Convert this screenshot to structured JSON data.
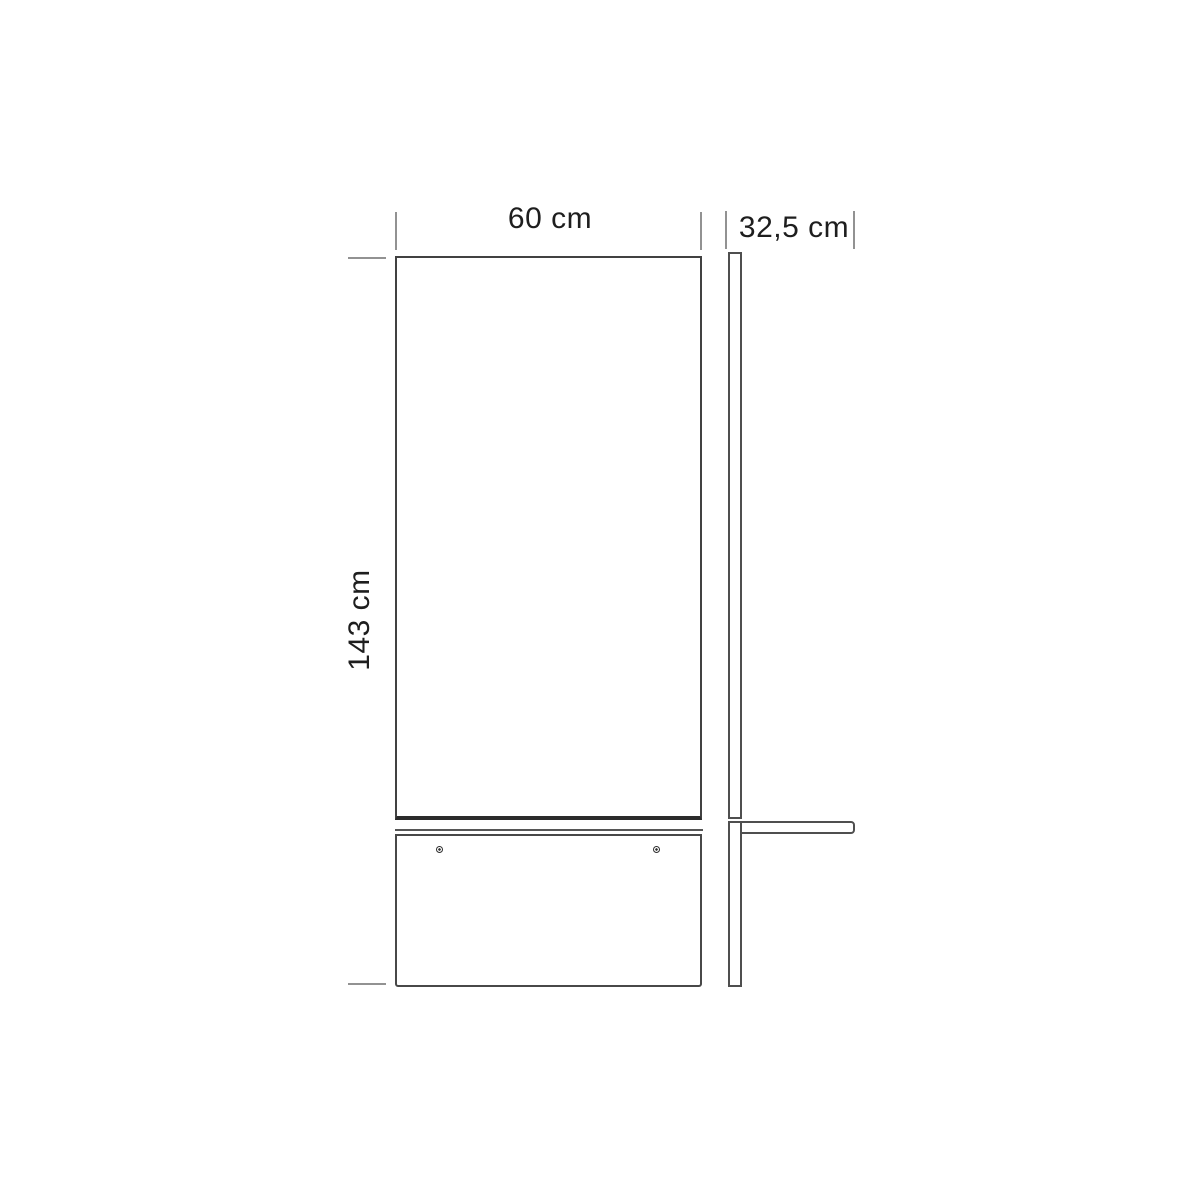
{
  "figure": {
    "type": "furniture-dimension-diagram",
    "views": {
      "front": "front-view",
      "side": "side-profile-view"
    },
    "labels": {
      "width": "60 cm",
      "depth": "32,5 cm",
      "height": "143 cm"
    },
    "colors": {
      "background": "#ffffff",
      "panel_outline": "#414141",
      "panel_outline_heavy": "#2b2b2b",
      "thin_line": "#565656",
      "side_outline": "#4f4f4f",
      "tick": "#929292",
      "text": "#1e1e1e"
    }
  }
}
